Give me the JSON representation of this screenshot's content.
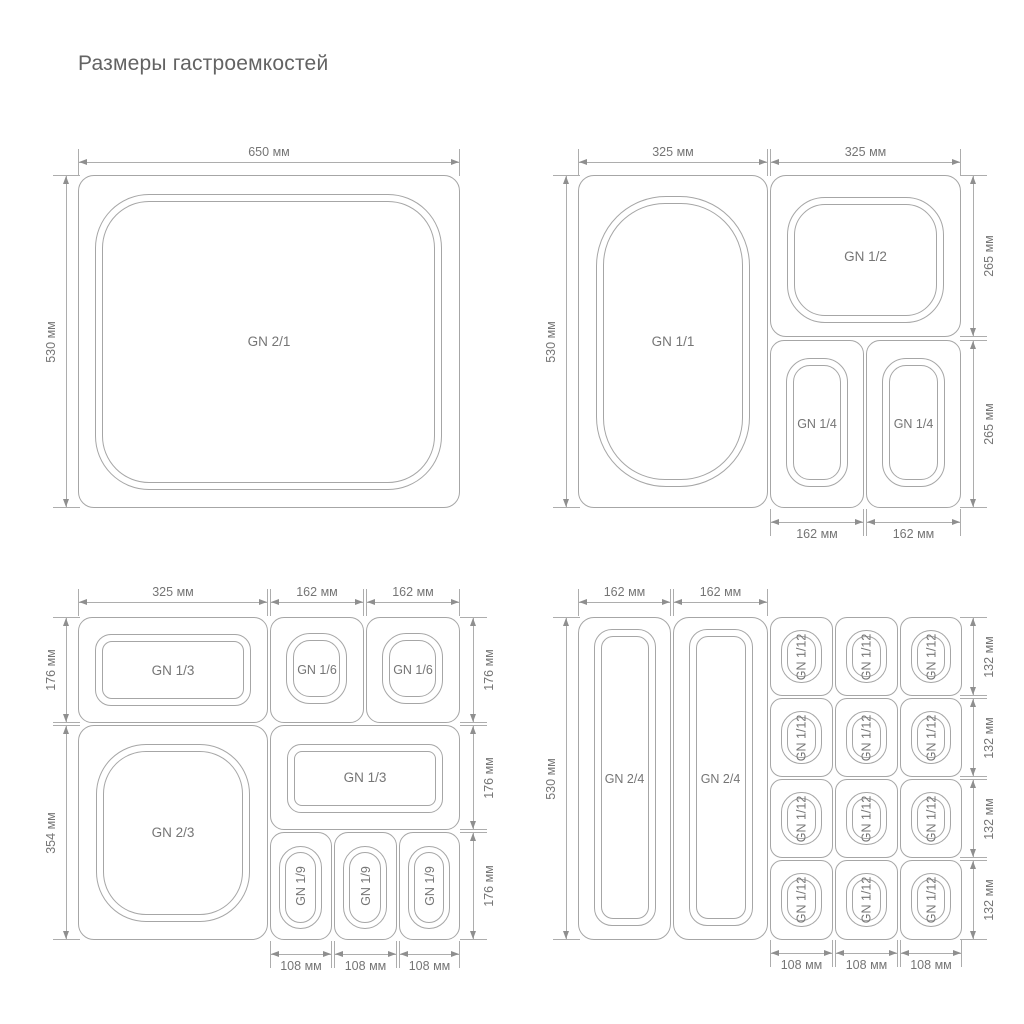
{
  "title": "Размеры гастроемкостей",
  "colors": {
    "line": "#a6a6a6",
    "dimension_line": "#adadad",
    "arrow": "#8f8f8f",
    "text": "#757575",
    "title": "#636363",
    "background": "#ffffff"
  },
  "quadrant_top_left": {
    "containers": [
      {
        "label": "GN 2/1"
      }
    ],
    "dimensions": {
      "top": [
        "650 мм"
      ],
      "left": [
        "530 мм"
      ]
    }
  },
  "quadrant_top_right": {
    "containers": [
      {
        "label": "GN 1/1"
      },
      {
        "label": "GN 1/2"
      },
      {
        "label": "GN 1/4"
      },
      {
        "label": "GN 1/4"
      }
    ],
    "dimensions": {
      "top": [
        "325 мм",
        "325 мм"
      ],
      "left": [
        "530 мм"
      ],
      "right": [
        "265 мм",
        "265 мм"
      ],
      "bottom": [
        "162 мм",
        "162 мм"
      ]
    }
  },
  "quadrant_bottom_left": {
    "containers": [
      {
        "label": "GN 1/3"
      },
      {
        "label": "GN 1/6"
      },
      {
        "label": "GN 1/6"
      },
      {
        "label": "GN 2/3"
      },
      {
        "label": "GN 1/3"
      },
      {
        "label": "GN 1/9"
      },
      {
        "label": "GN 1/9"
      },
      {
        "label": "GN 1/9"
      }
    ],
    "dimensions": {
      "top": [
        "325 мм",
        "162 мм",
        "162 мм"
      ],
      "left": [
        "176 мм",
        "354 мм"
      ],
      "right": [
        "176 мм",
        "176 мм",
        "176 мм"
      ],
      "bottom": [
        "108 мм",
        "108 мм",
        "108 мм"
      ]
    }
  },
  "quadrant_bottom_right": {
    "containers": [
      {
        "label": "GN 2/4"
      },
      {
        "label": "GN 2/4"
      },
      {
        "label": "GN 1/12"
      },
      {
        "label": "GN 1/12"
      },
      {
        "label": "GN 1/12"
      },
      {
        "label": "GN 1/12"
      },
      {
        "label": "GN 1/12"
      },
      {
        "label": "GN 1/12"
      },
      {
        "label": "GN 1/12"
      },
      {
        "label": "GN 1/12"
      },
      {
        "label": "GN 1/12"
      },
      {
        "label": "GN 1/12"
      },
      {
        "label": "GN 1/12"
      },
      {
        "label": "GN 1/12"
      }
    ],
    "dimensions": {
      "top": [
        "162 мм",
        "162 мм"
      ],
      "left": [
        "530 мм"
      ],
      "right": [
        "132 мм",
        "132 мм",
        "132 мм",
        "132 мм"
      ],
      "bottom": [
        "108 мм",
        "108 мм",
        "108 мм"
      ]
    }
  }
}
